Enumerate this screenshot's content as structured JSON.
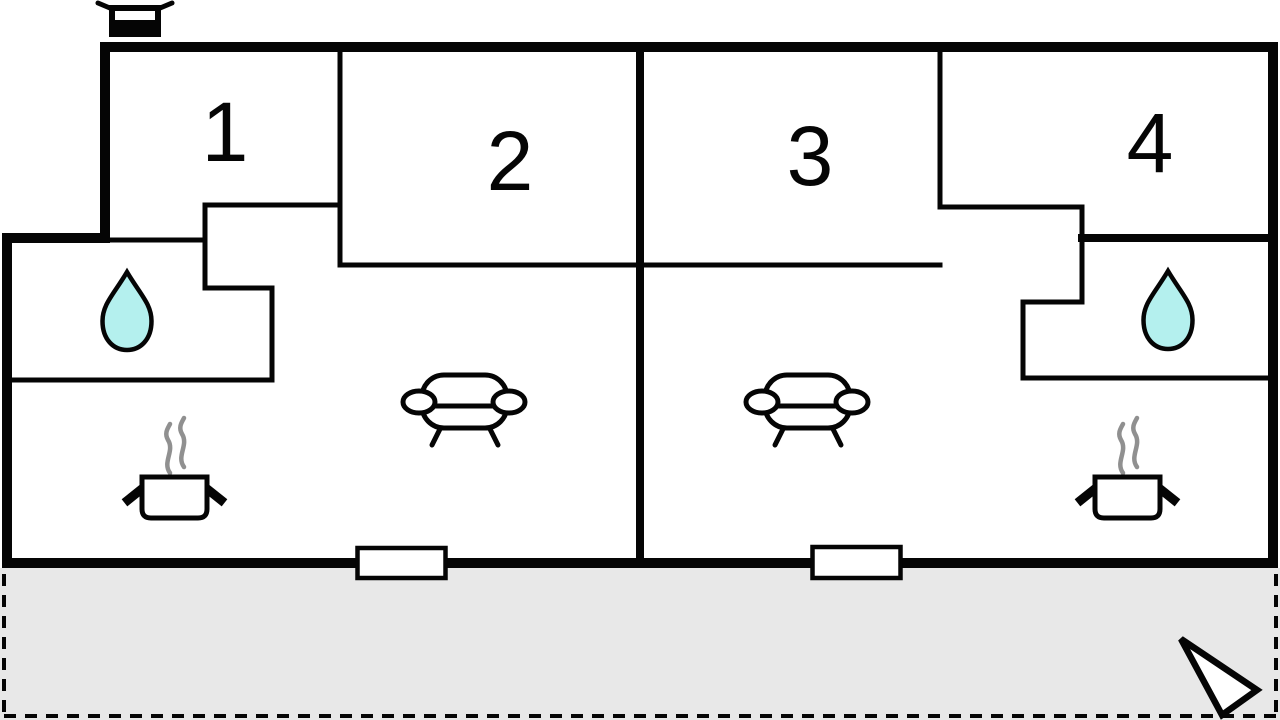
{
  "rooms": [
    {
      "label": "1"
    },
    {
      "label": "2"
    },
    {
      "label": "3"
    },
    {
      "label": "4"
    }
  ],
  "icons": {
    "grill": "grill-icon",
    "water_drop_left": "water-drop-icon",
    "water_drop_right": "water-drop-icon",
    "sofa_left": "sofa-icon",
    "sofa_right": "sofa-icon",
    "cooking_pot_left": "cooking-pot-icon",
    "cooking_pot_right": "cooking-pot-icon",
    "door_left": "door-opening",
    "door_right": "door-opening",
    "north_arrow": "north-arrow-icon"
  },
  "colors": {
    "wall": "#050505",
    "terrace": "#e8e8e8",
    "water": "#b4f0ee",
    "steam": "#909090",
    "fill": "#ffffff"
  }
}
